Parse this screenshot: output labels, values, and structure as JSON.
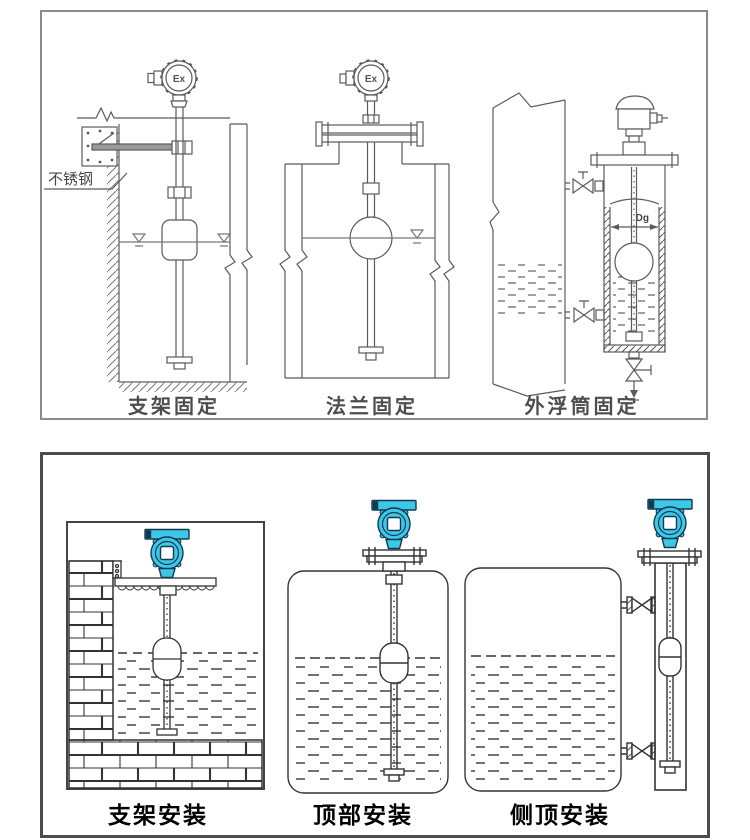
{
  "page": {
    "background": "#ffffff"
  },
  "colors": {
    "transmitter_cyan": "#3cc8e6",
    "transmitter_outline": "#14384f",
    "display_white": "#ffffff",
    "top_line_gray": "#5a5a5a",
    "bottom_line_dark": "#333333"
  },
  "top_panel": {
    "figures": [
      {
        "label": "支架固定",
        "head_label": "Ex",
        "annotation": "不锈钢"
      },
      {
        "label": "法兰固定",
        "head_label": "Ex"
      },
      {
        "label": "外浮筒固定",
        "dimension_label": "Dg"
      }
    ]
  },
  "bottom_panel": {
    "figures": [
      {
        "label": "支架安装"
      },
      {
        "label": "顶部安装"
      },
      {
        "label": "侧顶安装"
      }
    ]
  }
}
